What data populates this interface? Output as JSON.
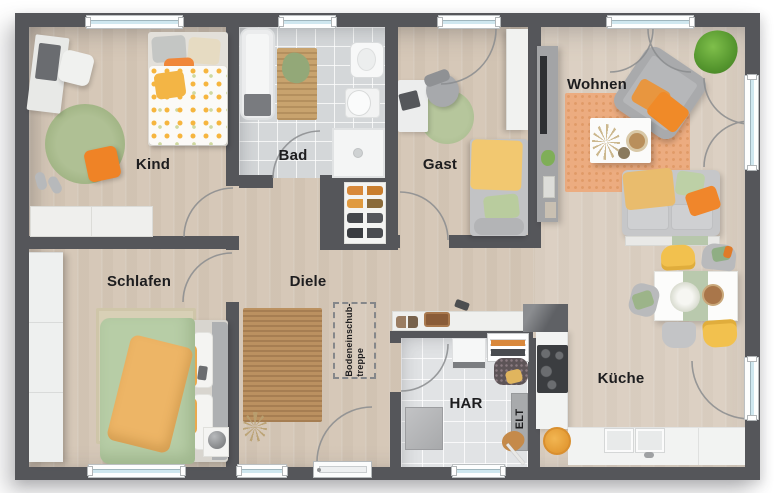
{
  "rooms": {
    "kind": {
      "label": "Kind"
    },
    "bad": {
      "label": "Bad"
    },
    "gast": {
      "label": "Gast"
    },
    "wohnen": {
      "label": "Wohnen"
    },
    "schlafen": {
      "label": "Schlafen"
    },
    "diele": {
      "label": "Diele"
    },
    "har": {
      "label": "HAR"
    },
    "kueche": {
      "label": "Küche"
    },
    "elt": {
      "label": "ELT"
    }
  },
  "annotations": {
    "attic_ladder": {
      "line1": "Bodeneinschub-",
      "line2": "treppe"
    }
  },
  "colors": {
    "wall": "#55565a",
    "wood_floor": "#d9ccbd",
    "bath_tile": "#d4d7d9",
    "har_tile": "#e1e3e5",
    "accent_orange": "#f0862b",
    "accent_yellow": "#f2c14e",
    "accent_green": "#aec08f",
    "rug_orange": "#ecac80",
    "rug_jute": "#bb9160",
    "window_glass": "#cfe7ef"
  }
}
